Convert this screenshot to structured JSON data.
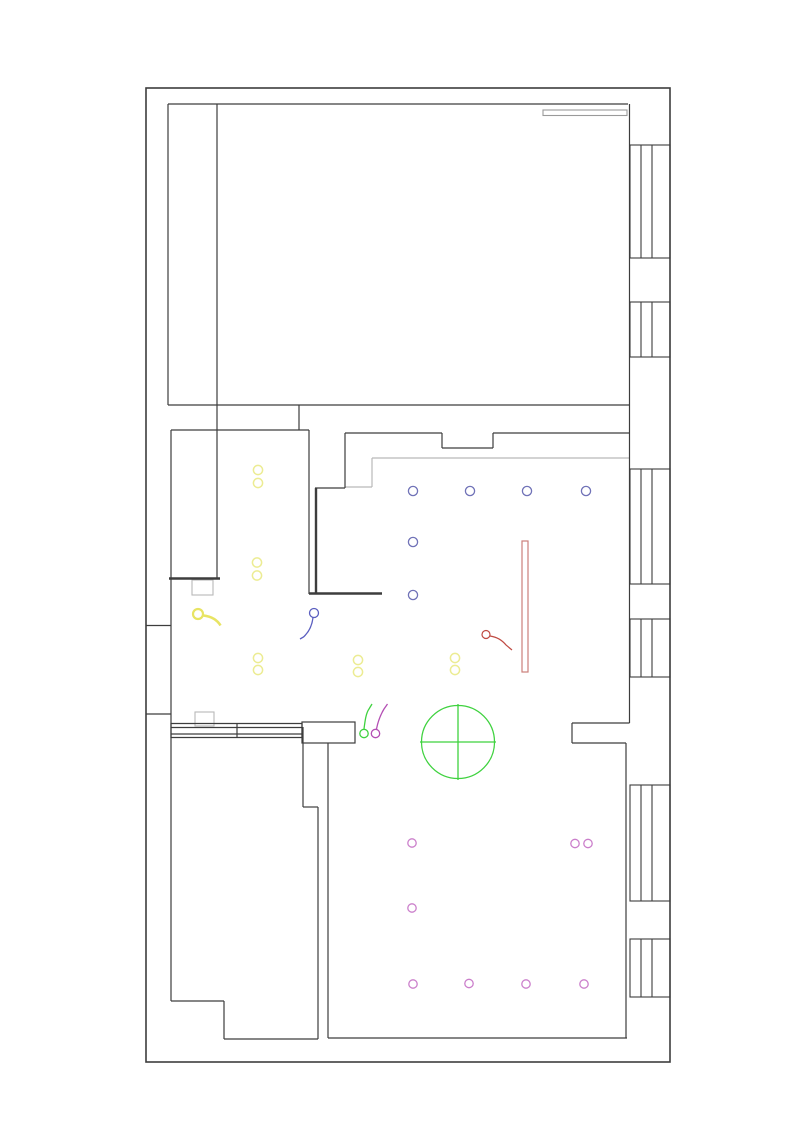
{
  "canvas": {
    "width": 800,
    "height": 1131,
    "background": "#ffffff"
  },
  "plan": {
    "colors": {
      "wall": "#3d3d3d",
      "wall_light": "#b9b9b9",
      "beam_gray": "#9a9a9a",
      "blue": "#7173b8",
      "blue_switch": "#5b5fc0",
      "red_fixture": "#cc7f7a",
      "red_switch": "#bf4a42",
      "green": "#3fd23f",
      "magenta": "#cb7fcb",
      "magenta_switch": "#b44fb4",
      "yellow": "#ecec93",
      "yellow_lamp": "#e8e463"
    },
    "outer_wall": {
      "x": 146,
      "y": 88,
      "w": 524,
      "h": 974,
      "stroke_width": 1.6
    },
    "wall_lines": [
      [
        168,
        405,
        168,
        104
      ],
      [
        168,
        104,
        628,
        104
      ],
      [
        629.5,
        104,
        629.5,
        723
      ],
      [
        217,
        104,
        217,
        578
      ],
      [
        168,
        405,
        630,
        405
      ],
      [
        299,
        405,
        299,
        430
      ],
      [
        171,
        430,
        309,
        430
      ],
      [
        171,
        430,
        171,
        1001
      ],
      [
        146,
        625.5,
        171,
        625.5
      ],
      [
        146,
        714,
        171,
        714
      ],
      [
        309,
        430,
        309,
        594
      ],
      [
        315,
        488,
        345,
        488
      ],
      [
        345,
        433,
        345,
        488
      ],
      [
        345,
        433,
        442,
        433
      ],
      [
        442,
        433,
        442,
        448
      ],
      [
        442,
        448,
        493,
        448
      ],
      [
        493,
        433,
        493,
        448
      ],
      [
        493,
        433,
        629.5,
        433
      ],
      [
        572,
        723,
        629.5,
        723
      ],
      [
        572,
        723,
        572,
        743
      ],
      [
        572,
        743,
        626,
        743
      ],
      [
        626,
        743,
        626,
        1038
      ],
      [
        328,
        743,
        328,
        1038
      ],
      [
        328,
        1038,
        627,
        1038
      ],
      [
        303,
        727,
        303,
        807
      ],
      [
        303,
        807,
        318,
        807
      ],
      [
        318,
        807,
        318,
        1039
      ],
      [
        224,
        1039,
        318,
        1039
      ],
      [
        224,
        1001,
        224,
        1039
      ],
      [
        171,
        1001,
        224,
        1001
      ],
      [
        171,
        723.5,
        302,
        723.5
      ],
      [
        171,
        727.5,
        302,
        727.5
      ],
      [
        171,
        734,
        302,
        734
      ],
      [
        171,
        737.5,
        302,
        737.5
      ],
      [
        171,
        723,
        171,
        738
      ],
      [
        237,
        723,
        237,
        738
      ],
      [
        302,
        723,
        302,
        738
      ]
    ],
    "thick_wall_lines": [
      [
        169,
        578.5,
        220,
        578.5
      ],
      [
        309,
        593.5,
        382,
        593.5
      ],
      [
        316,
        488,
        316,
        593.5
      ]
    ],
    "door_rect": {
      "x": 302,
      "y": 722,
      "w": 53,
      "h": 21
    },
    "windows": {
      "x_left": 630,
      "x_right": 670,
      "mullion_x": [
        641,
        652
      ],
      "spans": [
        [
          145,
          258
        ],
        [
          302,
          357
        ],
        [
          469,
          584
        ],
        [
          619,
          677
        ],
        [
          785,
          901
        ],
        [
          939,
          997
        ]
      ]
    },
    "gray_lines": [
      [
        345,
        487,
        372,
        487
      ],
      [
        372,
        458,
        372,
        487
      ],
      [
        372,
        458,
        629,
        458
      ]
    ],
    "gray_rects": [
      {
        "x": 543,
        "y": 110,
        "w": 84,
        "h": 5.5,
        "name": "beam-outline"
      },
      {
        "x": 192,
        "y": 580,
        "w": 21,
        "h": 15,
        "name": "column-outline"
      },
      {
        "x": 195,
        "y": 712,
        "w": 19,
        "h": 14,
        "name": "column-outline"
      }
    ],
    "blue_downlights": {
      "r": 4.6,
      "centers": [
        [
          413,
          491
        ],
        [
          470,
          491
        ],
        [
          527,
          491
        ],
        [
          586,
          491
        ],
        [
          413,
          542
        ],
        [
          413,
          595
        ]
      ]
    },
    "blue_switch": {
      "circle": [
        314,
        613,
        4.5
      ],
      "path": "M313,617.5 C312,626 309,632 303.5,637 L300,639"
    },
    "red_fixture_rect": {
      "x": 522,
      "y": 541,
      "w": 6,
      "h": 131
    },
    "red_switch": {
      "circle": [
        486,
        634.5,
        4
      ],
      "path": "M490,636 C497,637 502,640 506,645 L512,650"
    },
    "green_marker": {
      "cx": 458,
      "cy": 742,
      "r": 36.5,
      "cross": [
        [
          420,
          742,
          496,
          742
        ],
        [
          458,
          704,
          458,
          780
        ]
      ]
    },
    "green_switch": {
      "circle": [
        364,
        733.5,
        4.2
      ],
      "path": "M364,729 C365,721 366,713 369,709 L372,704"
    },
    "magenta_switch": {
      "circle": [
        375.5,
        733.5,
        4.2
      ],
      "path": "M376.5,729 C378,721 381,714 384,709 L387.5,704"
    },
    "magenta_downlights": {
      "r": 4.2,
      "centers": [
        [
          412,
          843
        ],
        [
          575,
          843.5
        ],
        [
          588,
          843.5
        ],
        [
          412,
          908
        ],
        [
          413,
          984
        ],
        [
          469,
          983.5
        ],
        [
          526,
          984
        ],
        [
          584,
          984
        ]
      ]
    },
    "yellow_downlights": {
      "r": 4.6,
      "centers": [
        [
          258,
          470
        ],
        [
          258,
          483
        ],
        [
          257,
          562.5
        ],
        [
          257,
          575.5
        ],
        [
          258,
          658
        ],
        [
          258,
          670
        ],
        [
          358,
          660
        ],
        [
          358,
          672
        ],
        [
          455,
          658
        ],
        [
          455,
          670
        ]
      ]
    },
    "yellow_lamp": {
      "circle": [
        198,
        614,
        5
      ],
      "path": "M203.5,615.5 C211,616.5 217,619.5 220.5,625.5"
    }
  }
}
